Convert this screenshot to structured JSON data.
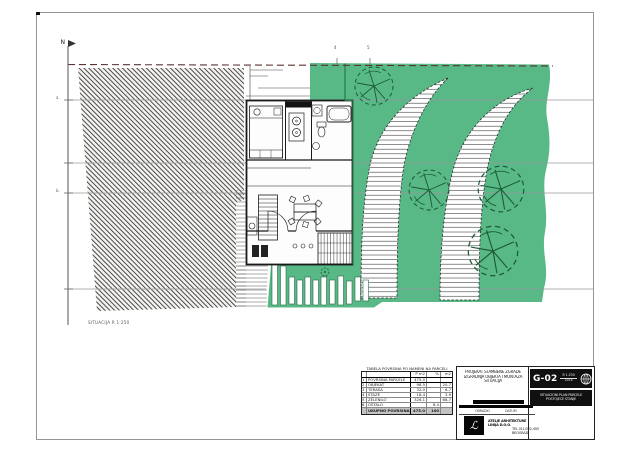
{
  "colors": {
    "green": "#58b886",
    "tree": "#1d5c38",
    "green_line": "#2e7d4f",
    "survey": "#9a9a9a",
    "boundary": "#5c3333",
    "ink": "#1a1a1a"
  },
  "annotations": {
    "north_label": "N",
    "top_tick_1": "4",
    "top_tick_2": "5",
    "left_tick_1": "a.",
    "left_tick_2": "b.",
    "scale_note": "SITUACIJA  R 1:250"
  },
  "area_table": {
    "caption": "TABELA POVRSINA PO NAMENI NA PARCELI",
    "col1": "P m2",
    "col2": "%",
    "col3": "m2",
    "rows": [
      [
        "1",
        "POVRSINA PARCELE",
        "475.0",
        "",
        ""
      ],
      [
        "2",
        "OBJEKAT",
        "98.5",
        "",
        "20.7"
      ],
      [
        "3",
        "TERASA",
        "32.0",
        "",
        "6.7"
      ],
      [
        "4",
        "STAZE",
        "18.4",
        "",
        "3.9"
      ],
      [
        "5",
        "ZELENILO",
        "326.1",
        "",
        "68.7"
      ],
      [
        "6",
        "OSTALO",
        "",
        "8.4",
        ""
      ]
    ],
    "total": [
      "",
      "UKUPNO POVRSINA",
      "475.0",
      "100",
      ""
    ]
  },
  "title_block": {
    "project_line1": "PROJEKAT STAMBENE ZGRADE",
    "project_line2": "IZGRADNJA OBJEKTA I MONTAZA",
    "project_line3": "SITUACIJA",
    "sheet_code": "G-02",
    "scale_label": "R 1:250",
    "scale_sub": "2014",
    "stamp_line1": "SITUACIONI PLAN PARCELE",
    "stamp_line2": "POSTOJECE STANJE",
    "sig_label_1": "OBRADIO",
    "sig_label_2": "DATUM",
    "logo_mark": "ℒ",
    "firm_line1": "ATELJE ARHITEKTURE",
    "firm_line2": "LINIJA D.O.O.",
    "contact_line1": "TEL 011/322-455",
    "contact_line2": "BEOGRAD"
  }
}
